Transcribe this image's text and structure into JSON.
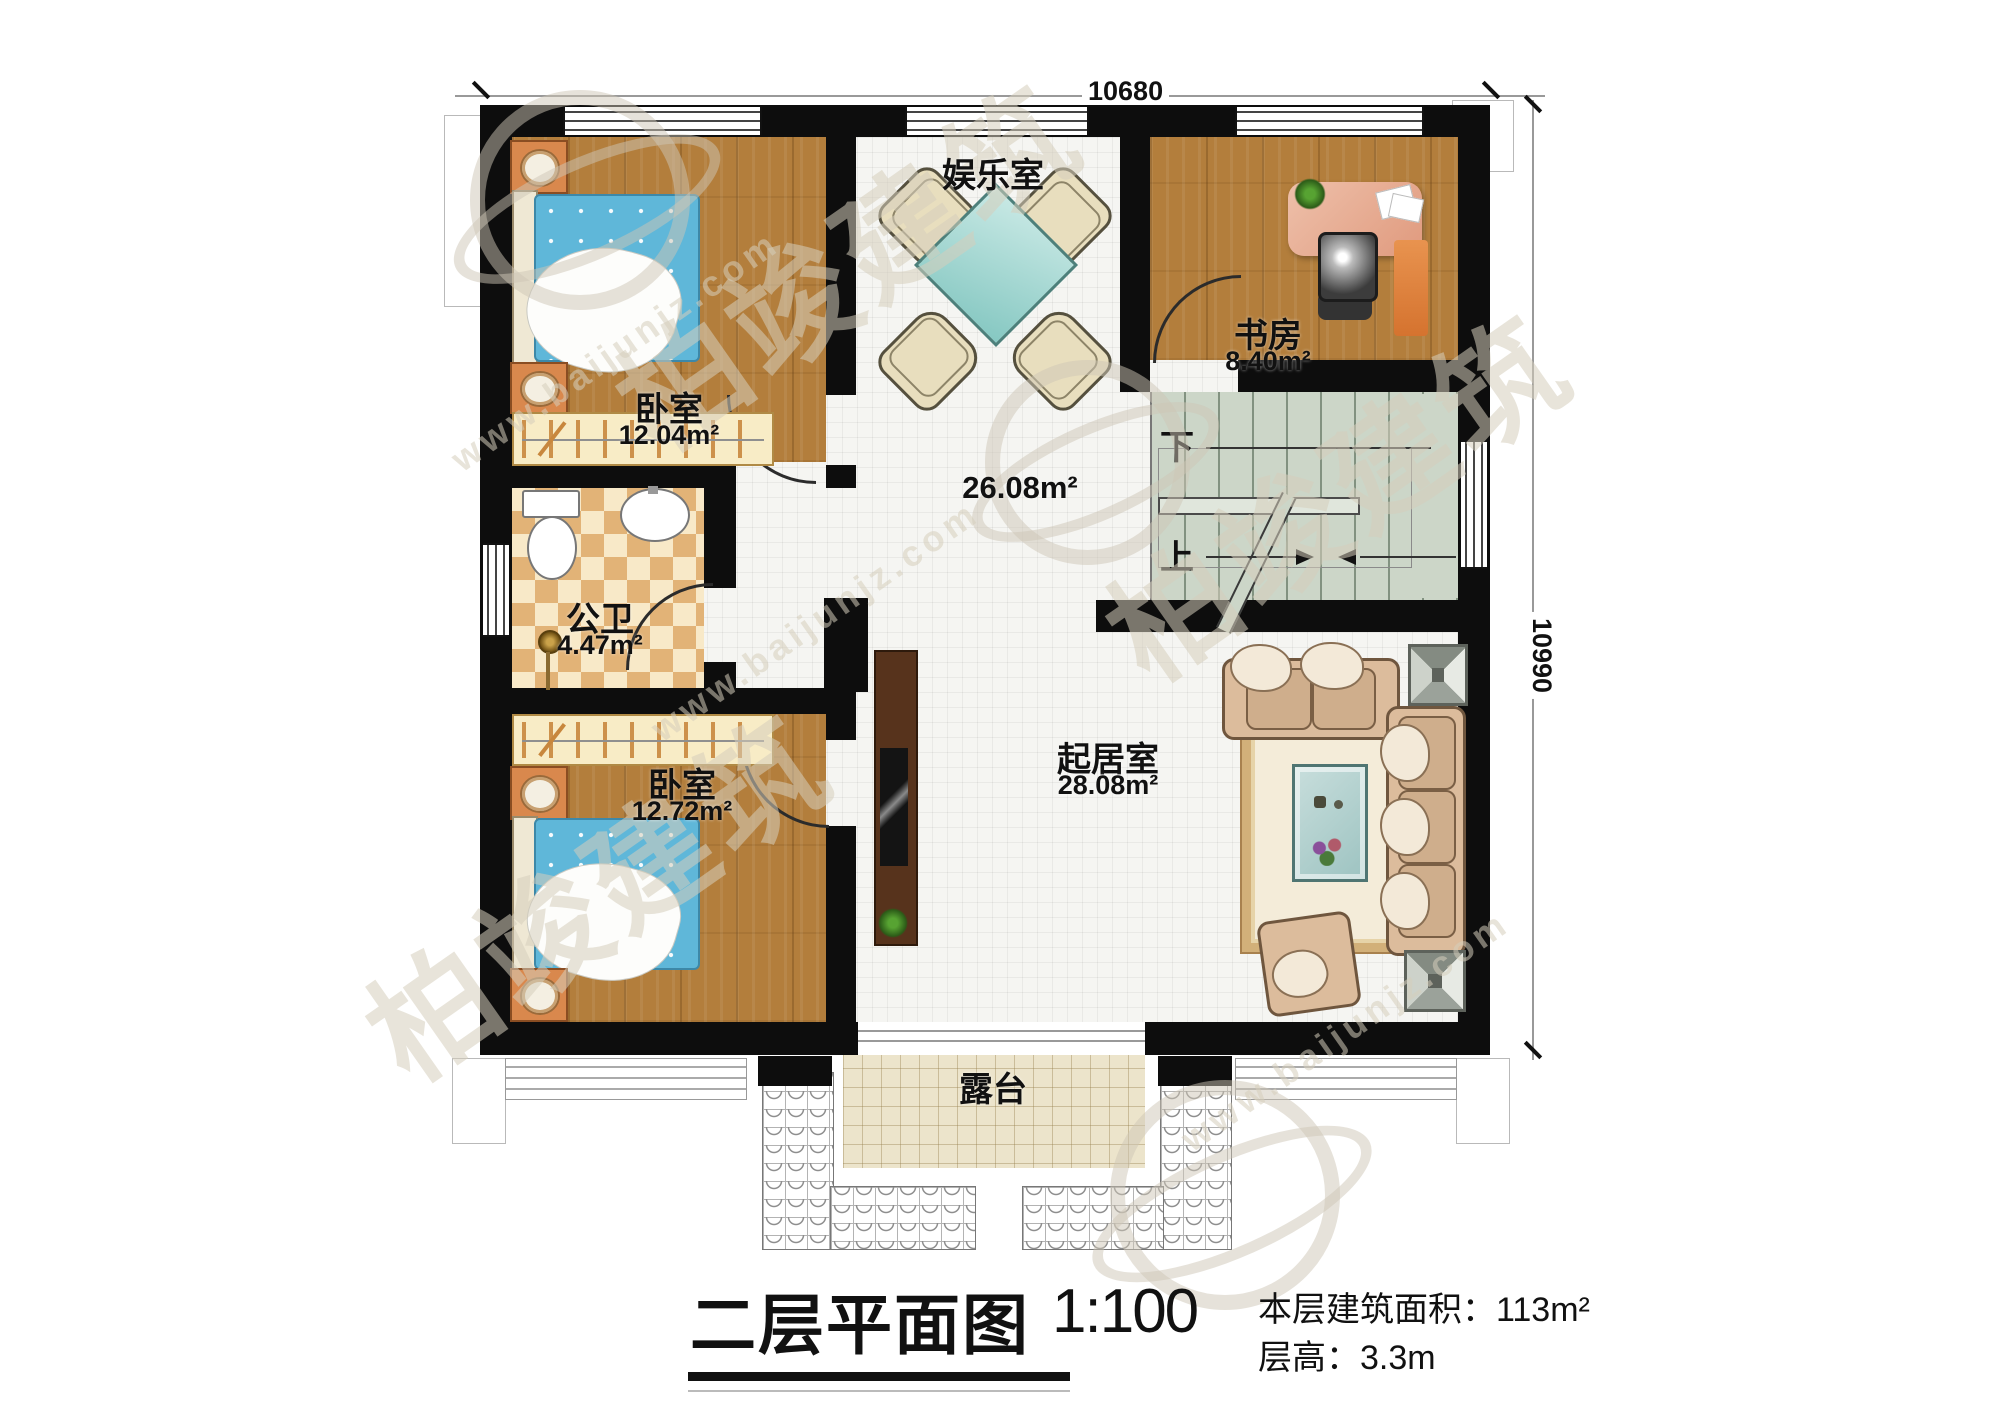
{
  "dimensions": {
    "top": "10680",
    "right": "10990"
  },
  "rooms": {
    "entertainment": {
      "name": "娱乐室"
    },
    "hall": {
      "area": "26.08m²"
    },
    "study": {
      "name": "书房",
      "area": "8.40m²"
    },
    "bedroom_top": {
      "name": "卧室",
      "area": "12.04m²"
    },
    "bathroom": {
      "name": "公卫",
      "area": "4.47m²"
    },
    "bedroom_bottom": {
      "name": "卧室",
      "area": "12.72m²"
    },
    "living": {
      "name": "起居室",
      "area": "28.08m²"
    },
    "terrace": {
      "name": "露台"
    }
  },
  "stairs": {
    "down": "下",
    "up": "上"
  },
  "title_block": {
    "title": "二层平面图",
    "scale": "1:100",
    "area_label": "本层建筑面积：",
    "area_value": "113m²",
    "height_label": "层高：",
    "height_value": "3.3m"
  },
  "watermark": {
    "site": "www.baijunjz.com",
    "brand": "柏竣建筑"
  }
}
